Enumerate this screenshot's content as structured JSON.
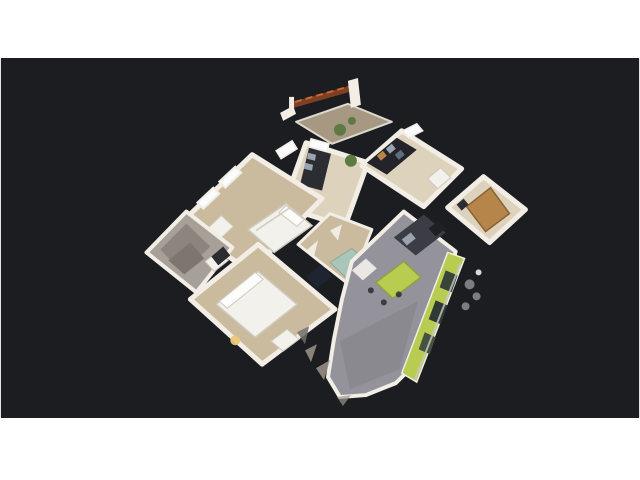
{
  "viewer": {
    "app": "3d-tour-dollhouse-viewer",
    "view_mode": "dollhouse",
    "canvas_bg": "#1c1d20",
    "letterbox_bg": "#ffffff"
  },
  "scene": {
    "subject": "furnished-apartment-3d-scan",
    "parts": [
      "balcony-pergola-beam",
      "terrace",
      "office",
      "bedroom-1",
      "bathroom",
      "bedroom-2",
      "hallway",
      "wardrobe-room",
      "entry-hall",
      "living-kitchen",
      "green-accent-wall",
      "balcony-objects",
      "mesh-debris"
    ],
    "colors": {
      "wall": "#f2eee5",
      "wall_dim": "#d9d2c4",
      "carpet": "#cbbb9e",
      "carpet_light": "#ddd3bd",
      "carpet_dark": "#b3a284",
      "bath_floor": "#a6a099",
      "bath_facet": "#8b857d",
      "bath_facet_dark": "#7c766f",
      "bed_white": "#f3f1ec",
      "pillow_white": "#fdfdfc",
      "bed_shadow": "#cfcabf",
      "furniture_dark": "#2c2d33",
      "shelf_dark": "#232329",
      "counter_dark": "#3c3d44",
      "fridge_dark": "#1f2024",
      "floor_gray": "#94929a",
      "floor_gray_dark": "#75737b",
      "accent_green": "#b9cc52",
      "accent_green_dark": "#8ea33c",
      "strip_window_1": "#39433a",
      "strip_window_2": "#2f3a33",
      "strip_window_3": "#46523f",
      "window_glow": "#fafcff",
      "door_wood": "#b5854a",
      "door_wood_dark": "#8a6234",
      "beam_wood": "#7e3f22",
      "beam_light": "#c96a35",
      "plant_green": "#5d7a42",
      "lamp_glow": "#e9c67c",
      "terrace": "#b5a68c",
      "steel": "#9aa4b0",
      "clothes_blue": "#5d6f7e",
      "teal": "#a9c6b9",
      "teal_dark": "#8aa89c",
      "navy_patch": "#1e2430",
      "rail_silver": "#c9c9cc",
      "blob_gray": "#8e8e90",
      "blob_white": "#d8d8da",
      "debris": "#9c948a",
      "debris_dark": "#6e6a64"
    }
  }
}
